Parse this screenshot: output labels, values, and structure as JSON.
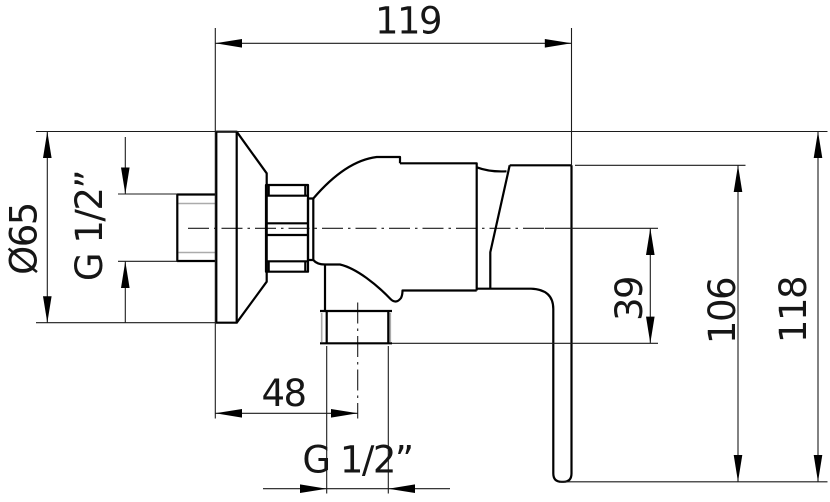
{
  "drawing": {
    "type": "technical-dimension-drawing",
    "subject": "wall-mounted shower mixer valve, side view",
    "background_color": "#ffffff",
    "outline_color": "#000000",
    "dimension_line_color": "#1c1c1c",
    "thread_line_color": "#ababab",
    "labels": {
      "width_top": "119",
      "flange_diameter": "Ø65",
      "inlet_thread": "G 1/2”",
      "outlet_drop": "39",
      "handle_height": "106",
      "total_height": "118",
      "outlet_offset": "48",
      "outlet_thread": "G 1/2”"
    }
  }
}
